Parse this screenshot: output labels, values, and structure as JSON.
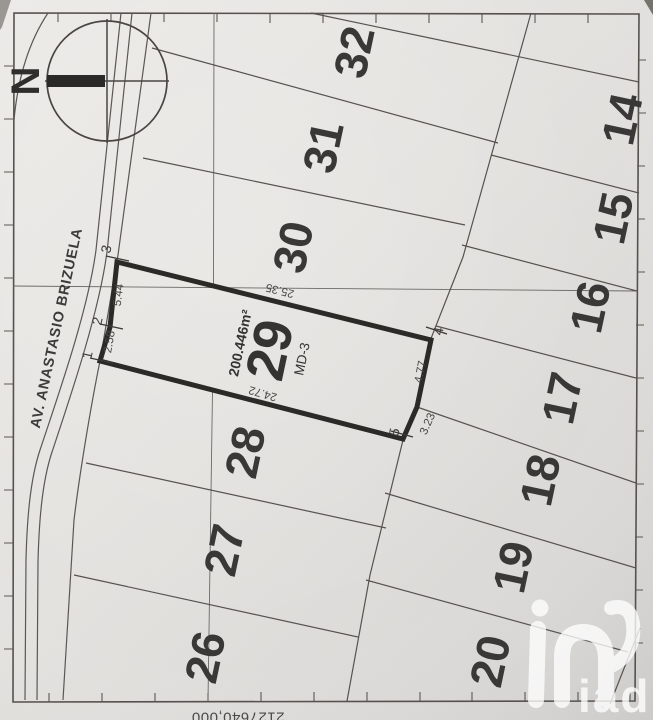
{
  "map": {
    "compass_label": "N",
    "street_name": "AV. ANASTASIO BRIZUELA",
    "grid_coordinate_label": "2127640,000",
    "lot29": {
      "number": "29",
      "area": "200.446m²",
      "zone": "MD-3",
      "corner_ids": [
        "1",
        "2",
        "3",
        "4",
        "5"
      ],
      "dimensions": [
        "2.58",
        "5.44",
        "25.35",
        "4.77",
        "3.23",
        "24.72"
      ]
    },
    "front_lots": [
      "26",
      "27",
      "28",
      "30",
      "31",
      "32"
    ],
    "rear_lots": [
      "14",
      "15",
      "16",
      "17",
      "18",
      "19",
      "20"
    ],
    "watermark_text": "iad"
  },
  "colors": {
    "paper": "#e5e3e0",
    "line": "#56534f",
    "grid_line": "#6b6965",
    "highlight_border": "#2c2a27",
    "text": "#3a3836",
    "dim_text": "#4a4845",
    "watermark": "#ffffff"
  }
}
